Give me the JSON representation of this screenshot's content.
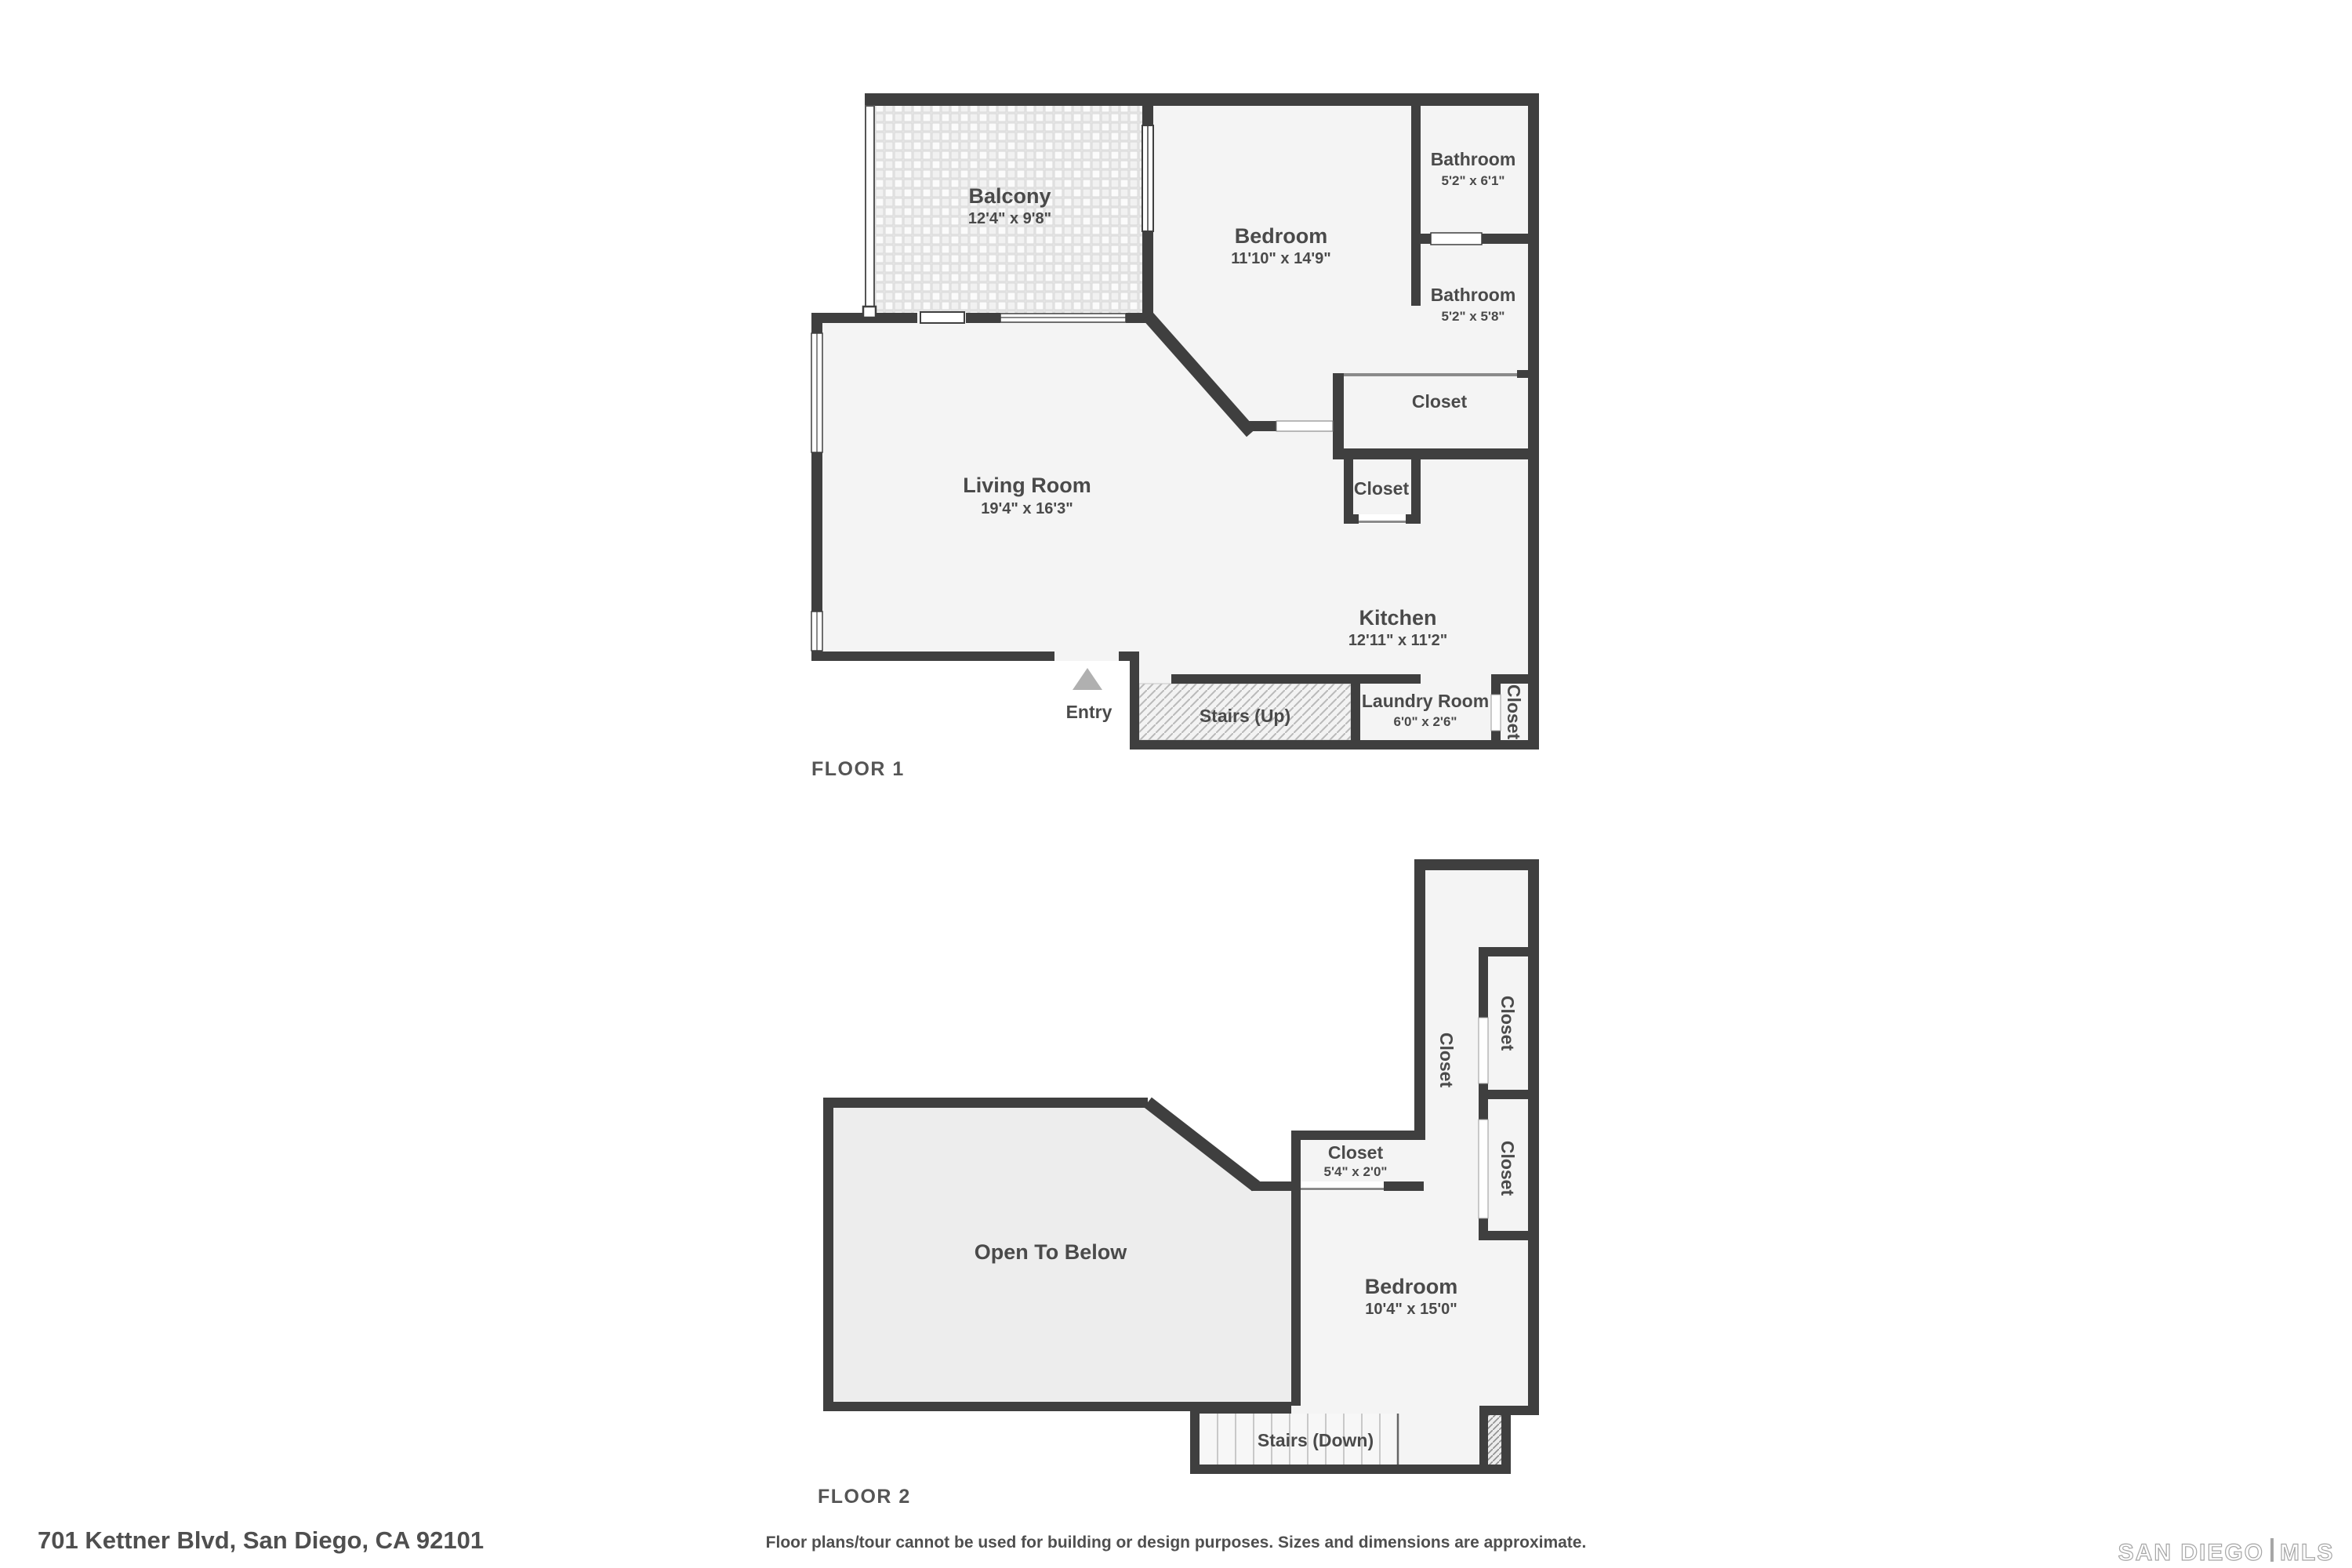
{
  "floor1": {
    "label": "FLOOR 1",
    "balcony": {
      "name": "Balcony",
      "dims": "12'4\" x 9'8\""
    },
    "bedroom": {
      "name": "Bedroom",
      "dims": "11'10\" x 14'9\""
    },
    "bathroom_top": {
      "name": "Bathroom",
      "dims": "5'2\" x 6'1\""
    },
    "bathroom_bottom": {
      "name": "Bathroom",
      "dims": "5'2\" x 5'8\""
    },
    "closet_hall": {
      "name": "Closet"
    },
    "closet_kitchen": {
      "name": "Closet"
    },
    "living": {
      "name": "Living Room",
      "dims": "19'4\" x 16'3\""
    },
    "kitchen": {
      "name": "Kitchen",
      "dims": "12'11\" x 11'2\""
    },
    "entry": {
      "name": "Entry"
    },
    "stairs": {
      "name": "Stairs (Up)"
    },
    "laundry": {
      "name": "Laundry Room",
      "dims": "6'0\" x 2'6\""
    },
    "closet_laundry": {
      "name": "Closet"
    }
  },
  "floor2": {
    "label": "FLOOR 2",
    "closet_corridor": {
      "name": "Closet"
    },
    "closet_upper": {
      "name": "Closet"
    },
    "closet_lower": {
      "name": "Closet"
    },
    "closet_room": {
      "name": "Closet",
      "dims": "5'4\" x 2'0\""
    },
    "open_below": {
      "name": "Open To Below"
    },
    "bedroom": {
      "name": "Bedroom",
      "dims": "10'4\" x 15'0\""
    },
    "stairs": {
      "name": "Stairs (Down)"
    }
  },
  "footer": {
    "address": "701 Kettner Blvd, San Diego, CA 92101",
    "disclaimer": "Floor plans/tour cannot be used for building or design purposes. Sizes and dimensions are approximate.",
    "logo_left": "SAN DIEGO",
    "logo_right": "MLS"
  },
  "colors": {
    "wall": "#3f3f3f",
    "floor": "#f4f4f4",
    "open_below_floor": "#ededed",
    "label": "#4a4a4a",
    "entry_arrow": "#b0b0b0"
  }
}
